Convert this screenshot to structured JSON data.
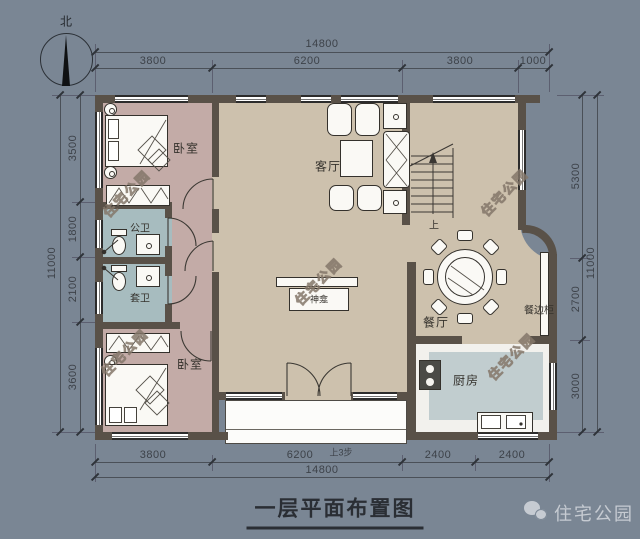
{
  "compass": {
    "north": "北"
  },
  "dims": {
    "top": {
      "total": "14800",
      "segments": [
        "3800",
        "6200",
        "3800",
        "1000"
      ]
    },
    "bottom": {
      "total": "14800",
      "segments": [
        "3800",
        "6200",
        "2400",
        "2400"
      ],
      "steps_note": "上3步"
    },
    "left": {
      "total": "11000",
      "segments": [
        "3500",
        "1800",
        "2100",
        "3600"
      ]
    },
    "right": {
      "total": "11000",
      "segments": [
        "5300",
        "2700",
        "3000"
      ]
    }
  },
  "rooms": {
    "bedroom_nw": "卧室",
    "bath_public": "公卫",
    "bath_ensuite": "套卫",
    "bedroom_sw": "卧室",
    "living": "客厅",
    "shrine": "神龛",
    "dining": "餐厅",
    "sideboard": "餐边柜",
    "kitchen": "厨房",
    "stairs_up": "上"
  },
  "watermark": {
    "text": "住宅公园"
  },
  "footer": {
    "title": "一层平面布置图",
    "brand": "住宅公园"
  },
  "colors": {
    "background": "#7a8694",
    "wall": "#595148",
    "floor_main": "#cdc1ad",
    "floor_bedroom": "#c3aba7",
    "floor_bath": "#a7bcbf",
    "floor_kitchen": "#c1cdcf",
    "dimension": "#3d4249"
  }
}
